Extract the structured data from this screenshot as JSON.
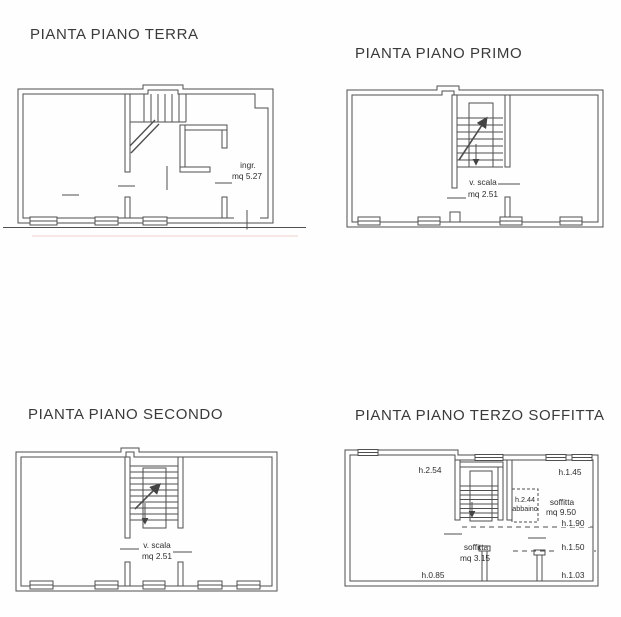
{
  "colors": {
    "background": "#fefefe",
    "line": "#4f4f4f",
    "text": "#2d2d2d",
    "title": "#3a3a3a"
  },
  "plans": {
    "terra": {
      "title": "PIANTA PIANO TERRA",
      "room_label": "ingr.",
      "room_area": "mq 5.27"
    },
    "primo": {
      "title": "PIANTA PIANO PRIMO",
      "stair_label": "v. scala",
      "stair_area": "mq 2.51"
    },
    "secondo": {
      "title": "PIANTA PIANO SECONDO",
      "stair_label": "v. scala",
      "stair_area": "mq 2.51"
    },
    "terzo": {
      "title": "PIANTA PIANO TERZO SOFFITTA",
      "h_top_left": "h.2.54",
      "h_top_right": "h.1.45",
      "dormer_height": "h.2.44",
      "dormer_label": "abbaino",
      "attic_right_label": "soffitta",
      "attic_right_area": "mq 9.50",
      "h_mid_right": "h.1.90",
      "h_low_right": "h.1.50",
      "attic_center_label": "soffitta",
      "attic_center_area": "mq 3.15",
      "h_bottom_left": "h.0.85",
      "h_bottom_right": "h.1.03"
    }
  }
}
